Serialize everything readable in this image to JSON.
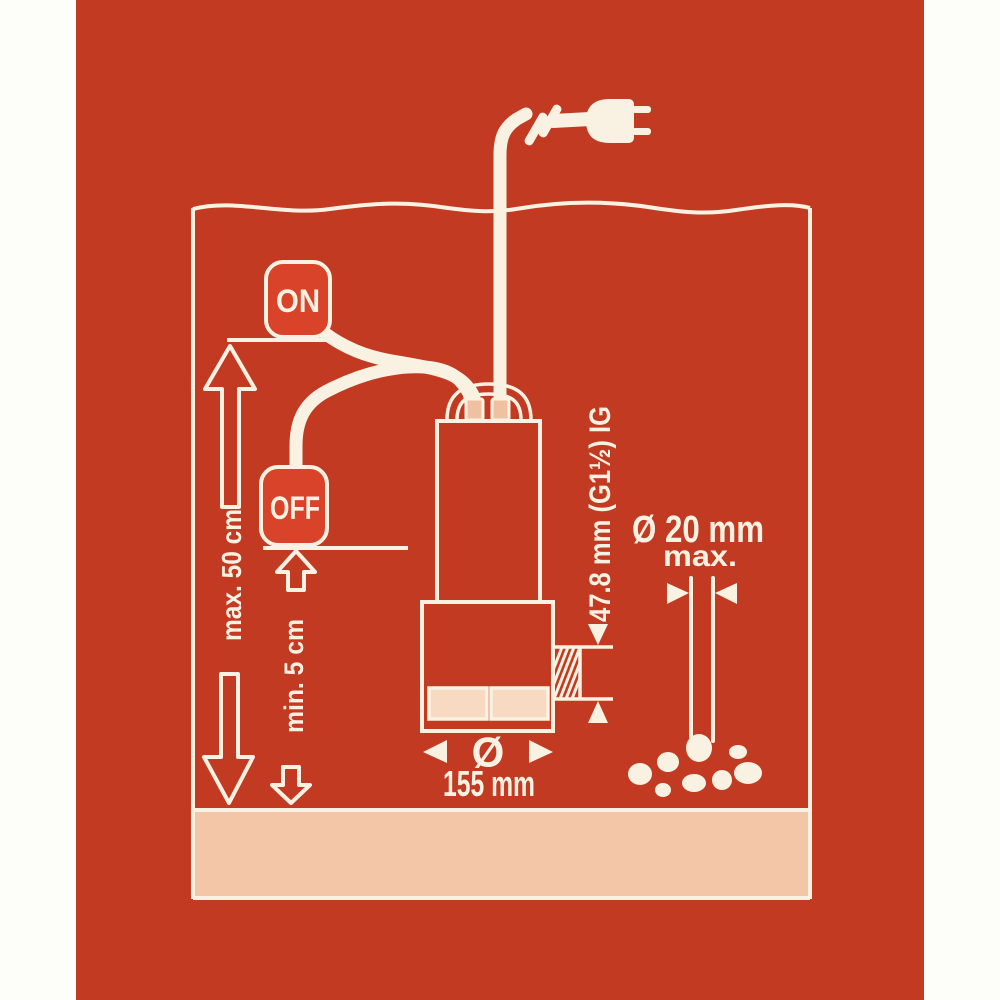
{
  "labels": {
    "float_on": "ON",
    "float_off": "OFF",
    "max_water_level": "max. 50 cm",
    "min_water_level": "min. 5 cm",
    "thread_size": "47.8 mm (G1½) IG",
    "grain_size": "Ø 20 mm",
    "grain_size_suffix": "max.",
    "diameter_symbol": "Ø",
    "diameter_value": "155 mm"
  },
  "colors": {
    "paper": "#fdfdfa",
    "bg": "#c23a22",
    "pump": "#c53c23",
    "cream": "#f9f2e2",
    "float": "#d8432a",
    "ground": "#f3c6a7",
    "vent": "#f8d9c2",
    "gland": "#efc1a0"
  }
}
